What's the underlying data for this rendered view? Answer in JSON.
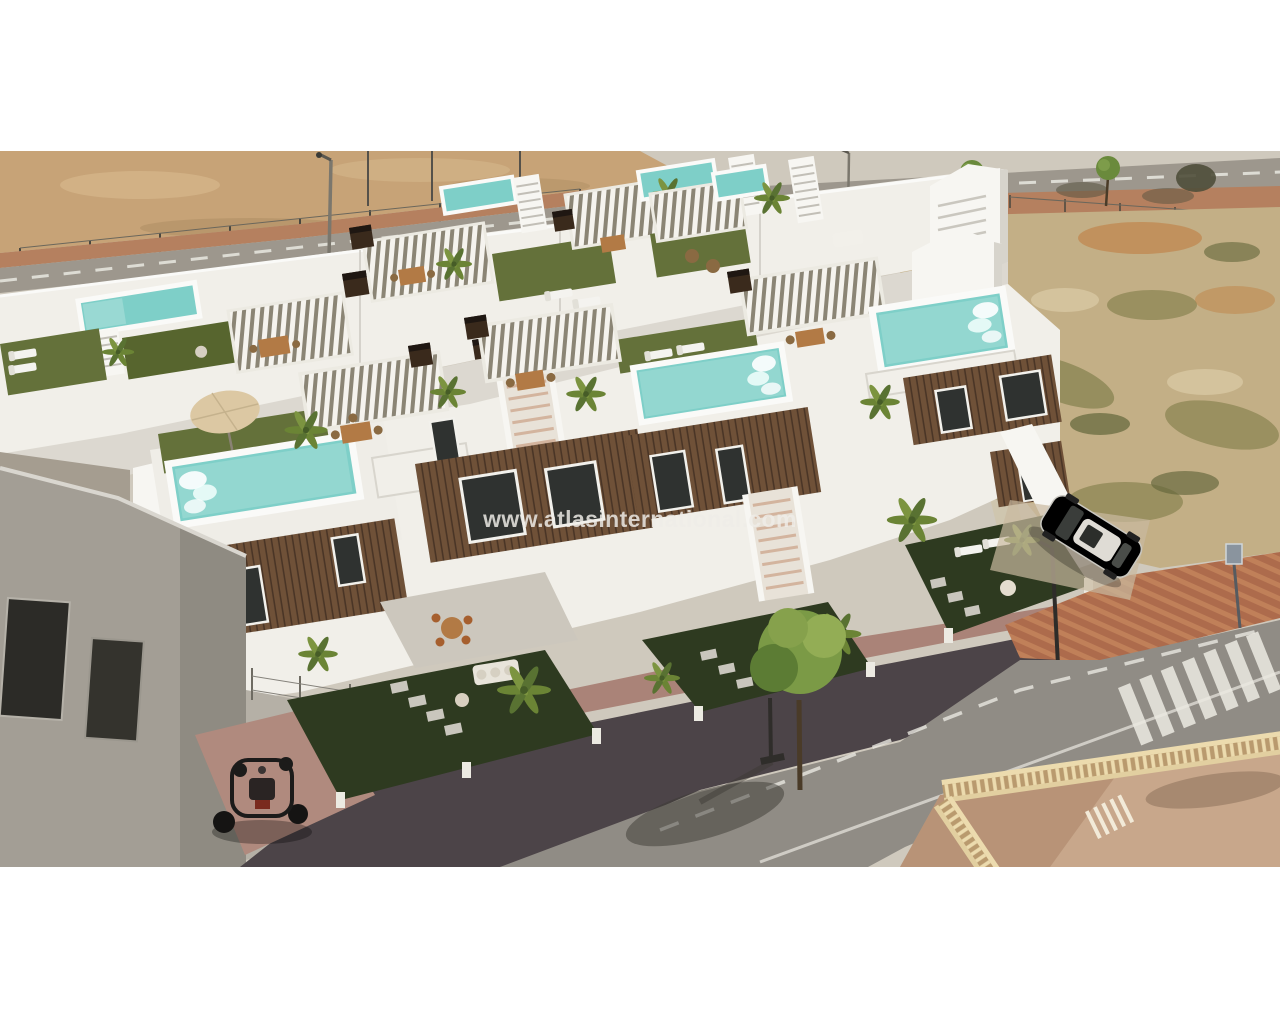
{
  "watermark": {
    "text": "www.atlasinternational.com"
  },
  "scene": {
    "elements": [
      "vacant-sand-lot",
      "perimeter-fence",
      "back-street",
      "street-lamps",
      "street-trees",
      "dry-scrubland",
      "back-townhouse-row",
      "front-townhouse-row",
      "rooftop-pools",
      "slatted-pergolas",
      "roof-gardens",
      "chimneys",
      "front-gardens",
      "stepping-stones",
      "outdoor-furniture",
      "palm-trees",
      "parked-white-car",
      "quad-buggy",
      "front-street",
      "pedestrian-crossing",
      "traffic-sign",
      "balustrade-terrace",
      "neighbouring-grey-building"
    ]
  },
  "colors": {
    "sand": "#c7a377",
    "sand-light": "#d8bb8f",
    "sidewalk-red": "#b5805f",
    "road-top": "#9d978d",
    "road-bottom": "#908c85",
    "lane-dark": "#4c4448",
    "pink-pavement": "#a87f74",
    "brick": "#ad6b4c",
    "brick-light": "#c08059",
    "scrub-base": "#c3af86",
    "scrub-olive": "#7e7c48",
    "scrub-dark": "#63663a",
    "house-white": "#f1efe9",
    "house-shadow": "#d7d4cc",
    "wall-dim": "#c6c3ba",
    "wood-brown": "#6f5138",
    "wood-dark": "#4a3526",
    "pool": "#7ecfc8",
    "pool-light": "#ace0da",
    "lawn-roof": "#64713a",
    "lawn-ground": "#2e3a20",
    "pergola-slat": "#f5f3ee",
    "pergola-shadow": "#8b8575",
    "fence-dark": "#2f2721",
    "chimney": "#3a2a1c",
    "table-wood": "#b27a45",
    "palm-green": "#6b8435",
    "white-line": "#e9e7e0",
    "balustrade": "#ecdbae",
    "terrace-floor": "#c8a78b",
    "car-white": "#ebe9e3",
    "watermark-color": "rgba(238,236,231,0.84)"
  }
}
